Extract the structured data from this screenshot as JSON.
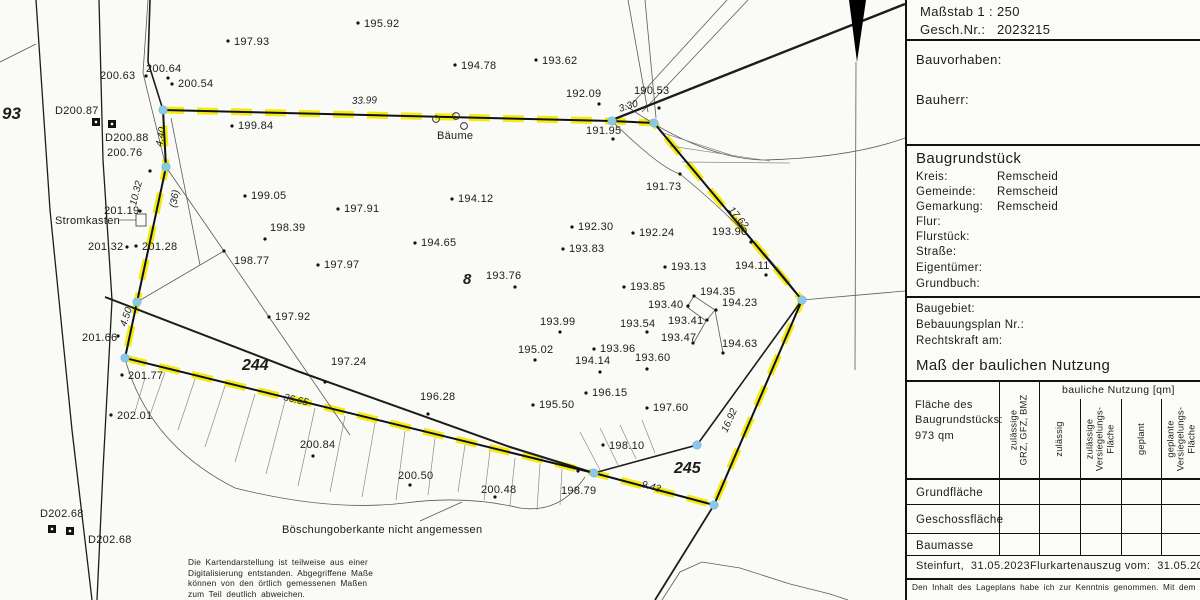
{
  "panel": {
    "massstab": "Maßstab 1 : 250",
    "gesch_label": "Gesch.Nr.:",
    "gesch_value": "2023215",
    "bauvorhaben": "Bauvorhaben:",
    "bauherr": "Bauherr:",
    "baugrundstueck": {
      "title": "Baugrundstück",
      "rows": [
        {
          "label": "Kreis:",
          "value": "Remscheid"
        },
        {
          "label": "Gemeinde:",
          "value": "Remscheid"
        },
        {
          "label": "Gemarkung:",
          "value": "Remscheid"
        },
        {
          "label": "Flur:",
          "value": ""
        },
        {
          "label": "Flurstück:",
          "value": ""
        },
        {
          "label": "Straße:",
          "value": ""
        },
        {
          "label": "Eigentümer:",
          "value": ""
        },
        {
          "label": "Grundbuch:",
          "value": ""
        }
      ]
    },
    "baugebiet_rows": [
      "Baugebiet:",
      "Bebauungsplan Nr.:",
      "Rechtskraft am:"
    ],
    "nutzung": {
      "title": "Maß der baulichen Nutzung",
      "area_label": "Fläche des\nBaugrundstücks:\n973 qm",
      "col_group": "bauliche Nutzung [qm]",
      "cols": [
        "zulässige\nGRZ, GFZ, BMZ",
        "zulässig",
        "zulässige\nVersiegelungs-\nFläche",
        "geplant",
        "geplante\nVersiegelungs-\nFläche"
      ],
      "rows": [
        "Grundfläche",
        "Geschossfläche",
        "Baumasse"
      ]
    },
    "footer_left": "Steinfurt,  31.05.2023",
    "footer_right": "Flurkartenauszug vom:  31.05.2023",
    "note": "Den Inhalt des Lageplans habe ich zur Kenntnis genommen. Mit dem"
  },
  "map": {
    "colors": {
      "boundary_yellow": "#f2ea00",
      "corner_blue": "#8ac7e9",
      "line": "#1c1c1c"
    },
    "points": [
      [
        358,
        23,
        "195.92",
        364,
        27
      ],
      [
        228,
        41,
        "197.93",
        234,
        45
      ],
      [
        455,
        65,
        "194.78",
        461,
        69
      ],
      [
        536,
        60,
        "193.62",
        542,
        64
      ],
      [
        599,
        104,
        "192.09",
        566,
        97
      ],
      [
        659,
        108,
        "190.53",
        634,
        94
      ],
      [
        613,
        139,
        "191.95",
        586,
        134
      ],
      [
        146,
        76,
        "200.63",
        100,
        79
      ],
      [
        168,
        78,
        "200.64",
        146,
        72
      ],
      [
        172,
        84,
        "200.54",
        178,
        87
      ],
      [
        232,
        126,
        "199.84",
        238,
        129
      ],
      [
        245,
        196,
        "199.05",
        251,
        199
      ],
      [
        338,
        209,
        "197.91",
        344,
        212
      ],
      [
        265,
        239,
        "198.39",
        270,
        231
      ],
      [
        452,
        199,
        "194.12",
        458,
        202
      ],
      [
        415,
        243,
        "194.65",
        421,
        246
      ],
      [
        224,
        251,
        "198.77",
        234,
        264
      ],
      [
        318,
        265,
        "197.97",
        324,
        268
      ],
      [
        269,
        317,
        "197.92",
        275,
        320
      ],
      [
        515,
        287,
        "193.76",
        486,
        279
      ],
      [
        572,
        227,
        "192.30",
        578,
        230
      ],
      [
        633,
        233,
        "192.24",
        639,
        236
      ],
      [
        563,
        249,
        "193.83",
        569,
        252
      ],
      [
        751,
        242,
        "193.90",
        712,
        235
      ],
      [
        665,
        267,
        "193.13",
        671,
        270
      ],
      [
        766,
        275,
        "194.11",
        735,
        269
      ],
      [
        624,
        287,
        "193.85",
        630,
        290
      ],
      [
        694,
        296,
        "194.35",
        700,
        295
      ],
      [
        716,
        310,
        "194.23",
        722,
        306
      ],
      [
        688,
        306,
        "193.40",
        648,
        308
      ],
      [
        707,
        320,
        "193.41",
        668,
        324
      ],
      [
        647,
        332,
        "193.54",
        620,
        327
      ],
      [
        693,
        343,
        "193.47",
        661,
        341
      ],
      [
        560,
        332,
        "193.99",
        540,
        325
      ],
      [
        723,
        353,
        "194.63",
        722,
        347
      ],
      [
        535,
        360,
        "195.02",
        518,
        353
      ],
      [
        594,
        349,
        "193.96",
        600,
        352
      ],
      [
        600,
        372,
        "194.14",
        575,
        364
      ],
      [
        647,
        369,
        "193.60",
        635,
        361
      ],
      [
        586,
        393,
        "196.15",
        592,
        396
      ],
      [
        533,
        405,
        "195.50",
        539,
        408
      ],
      [
        647,
        408,
        "197.60",
        653,
        411
      ],
      [
        325,
        382,
        "197.24",
        331,
        365
      ],
      [
        428,
        414,
        "196.28",
        420,
        400
      ],
      [
        313,
        456,
        "200.84",
        300,
        448
      ],
      [
        410,
        485,
        "200.50",
        398,
        479
      ],
      [
        495,
        497,
        "200.48",
        481,
        493
      ],
      [
        603,
        445,
        "198.10",
        609,
        449
      ],
      [
        578,
        471,
        "198.79",
        561,
        494
      ],
      [
        680,
        174,
        "191.73",
        646,
        190
      ],
      [
        140,
        211,
        "201.19",
        104,
        214
      ],
      [
        127,
        247,
        "201.32",
        88,
        250
      ],
      [
        136,
        246,
        "201.28",
        142,
        250
      ],
      [
        118,
        336,
        "201.66",
        82,
        341
      ],
      [
        122,
        375,
        "201.77",
        128,
        379
      ],
      [
        111,
        415,
        "202.01",
        117,
        419
      ],
      [
        150,
        171,
        "200.76",
        107,
        156
      ]
    ],
    "dpoints": [
      {
        "x": 96,
        "y": 122,
        "t": "D200.87",
        "lx": 55,
        "ly": 114
      },
      {
        "x": 112,
        "y": 124,
        "t": "D200.88",
        "lx": 105,
        "ly": 141
      },
      {
        "x": 52,
        "y": 529,
        "t": "D202.68",
        "lx": 40,
        "ly": 517
      },
      {
        "x": 70,
        "y": 531,
        "t": "D202.68",
        "lx": 88,
        "ly": 543
      }
    ],
    "measures": [
      {
        "t": "33.99",
        "x": 352,
        "y": 104,
        "r": -2
      },
      {
        "t": "3.30",
        "x": 620,
        "y": 112,
        "r": -18
      },
      {
        "t": "17.62",
        "x": 728,
        "y": 210,
        "r": 50
      },
      {
        "t": "16.92",
        "x": 727,
        "y": 433,
        "r": -66
      },
      {
        "t": "9.43",
        "x": 641,
        "y": 487,
        "r": 15
      },
      {
        "t": "36.65",
        "x": 283,
        "y": 400,
        "r": 13
      },
      {
        "t": "4.40",
        "x": 162,
        "y": 147,
        "r": -80
      },
      {
        "t": "10.32",
        "x": 136,
        "y": 206,
        "r": -76
      },
      {
        "t": "4.50",
        "x": 126,
        "y": 327,
        "r": -72
      },
      {
        "t": "(36)",
        "x": 176,
        "y": 208,
        "r": -80
      }
    ],
    "parcels": [
      {
        "t": "93",
        "x": 2,
        "y": 119,
        "s": 17
      },
      {
        "t": "8",
        "x": 463,
        "y": 284,
        "s": 15
      },
      {
        "t": "244",
        "x": 242,
        "y": 370,
        "s": 16
      },
      {
        "t": "245",
        "x": 674,
        "y": 473,
        "s": 16
      }
    ],
    "texts": [
      {
        "t": "Bäume",
        "x": 437,
        "y": 139
      },
      {
        "t": "Stromkasten",
        "x": 55,
        "y": 224
      },
      {
        "t": "Böschungoberkante nicht angemessen",
        "x": 282,
        "y": 533
      }
    ],
    "trees": [
      [
        436,
        119
      ],
      [
        456,
        116
      ],
      [
        464,
        126
      ]
    ],
    "blue_corners": [
      [
        163,
        110
      ],
      [
        612,
        121
      ],
      [
        654,
        123
      ],
      [
        802,
        300
      ],
      [
        714,
        505
      ],
      [
        594,
        473
      ],
      [
        697,
        445
      ],
      [
        125,
        358
      ],
      [
        137,
        302
      ],
      [
        166,
        167
      ]
    ],
    "disclaimer": "Die Kartendarstellung ist teilweise aus einer\nDigitalisierung entstanden. Abgegriffene Maße\nkönnen von den örtlich gemessenen Maßen\nzum Teil deutlich abweichen."
  }
}
